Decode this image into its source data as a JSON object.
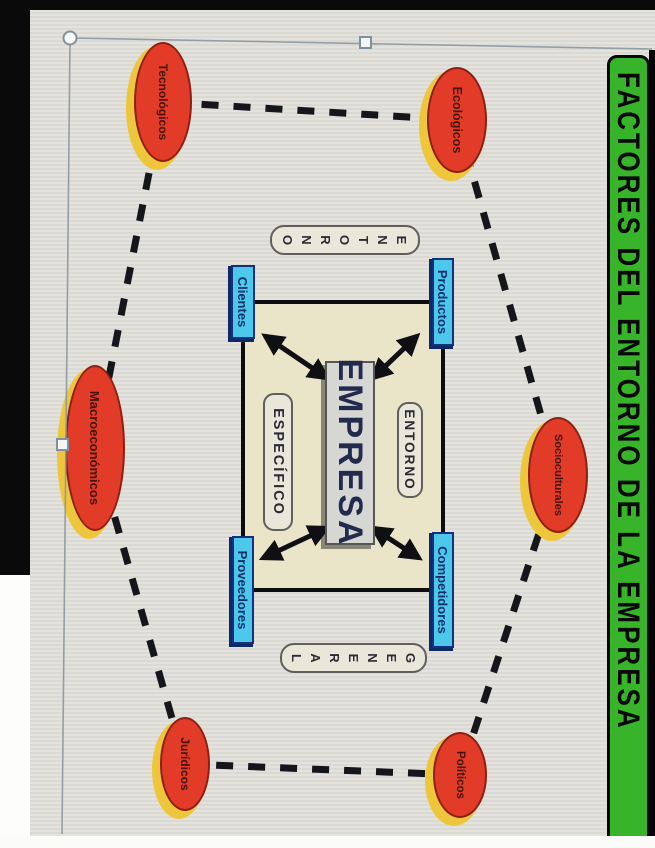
{
  "banner": {
    "title": "FACTORES DEL ENTORNO DE LA EMPRESA"
  },
  "diagram": {
    "company": {
      "label": "EMPRESA"
    },
    "inner_environment": {
      "top_label": "ENTORNO",
      "bottom_label": "ESPECÍFICO"
    },
    "outer_environment": {
      "left_vertical_label": "ENTORNO",
      "right_vertical_label": "GENERAL"
    },
    "micro_factors": [
      {
        "label": "Productos"
      },
      {
        "label": "Competidores"
      },
      {
        "label": "Clientes"
      },
      {
        "label": "Proveedores"
      }
    ],
    "macro_factors": [
      {
        "label": "Socioculturales"
      },
      {
        "label": "Ecológicos"
      },
      {
        "label": "Tecnológicos"
      },
      {
        "label": "Macroeconómicos"
      },
      {
        "label": "Jurídicos"
      },
      {
        "label": "Políticos"
      }
    ],
    "colors": {
      "banner_green": "#38b42a",
      "factor_red": "#e23b27",
      "factor_shadow_yellow": "#eec63c",
      "micro_cyan": "#4cc8ec",
      "micro_navy": "#14307a",
      "panel_cream": "#eae4c9",
      "slide_gray": "#dfddd7"
    }
  }
}
